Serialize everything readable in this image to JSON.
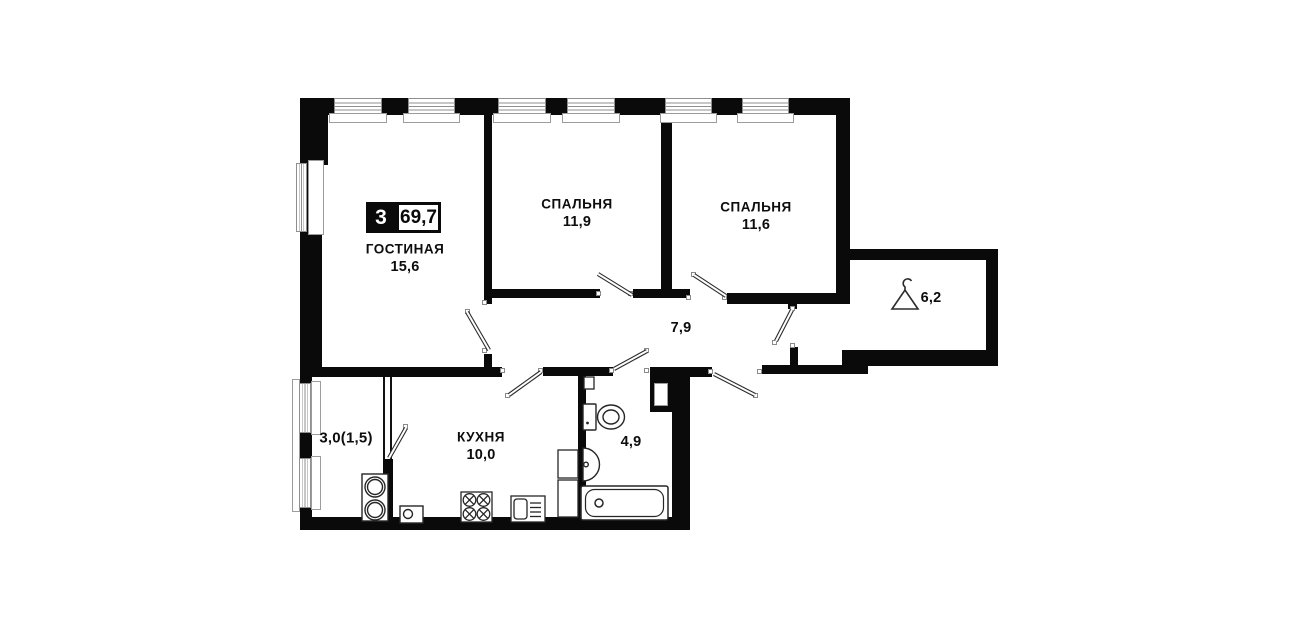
{
  "floorplan": {
    "badge": {
      "rooms_count": "3",
      "total_area": "69,7"
    },
    "rooms": {
      "living": {
        "name": "ГОСТИНАЯ",
        "area": "15,6"
      },
      "bedroom1": {
        "name": "СПАЛЬНЯ",
        "area": "11,9"
      },
      "bedroom2": {
        "name": "СПАЛЬНЯ",
        "area": "11,6"
      },
      "hallway": {
        "area": "7,9"
      },
      "entry": {
        "area": "6,2"
      },
      "balcony": {
        "area": "3,0(1,5)"
      },
      "kitchen": {
        "name": "КУХНЯ",
        "area": "10,0"
      },
      "bathroom": {
        "area": "4,9"
      }
    },
    "icons": {
      "entry_icon": "hanger-icon"
    },
    "colors": {
      "wall": "#0a0a0a",
      "background": "#ffffff",
      "frame": "#8f8f8f"
    }
  }
}
